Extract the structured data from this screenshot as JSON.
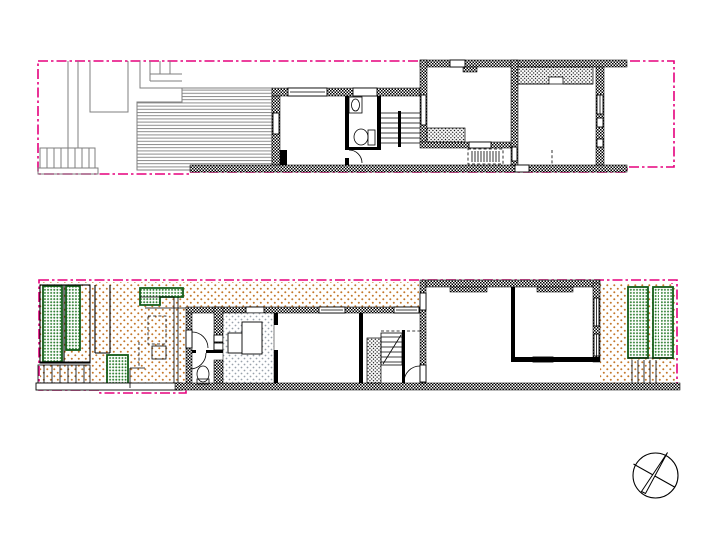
{
  "colors": {
    "boundary-pink": "#e5007d",
    "stipple-orange": "#c4782c",
    "planting-green": "#2b7c2e",
    "green-outline": "#135c18",
    "floor-gray": "#99a2ac",
    "deck-gray": "#8c8c8c",
    "line-gray": "#7f7f7f",
    "ink": "#000000",
    "paper": "#ffffff"
  },
  "symbols": {
    "north_arrow_icon": "north-arrow-compass",
    "boundary_line_style": "pink dash-dot site boundary",
    "wall_fill": "black crosshatch",
    "garden_ground_fill": "orange stipple dots",
    "planting_fill": "green stipple dots with dark green outline",
    "outbuilding_floor_fill": "gray stipple dots",
    "deck_fill": "gray horizontal lines",
    "stair_symbol": "parallel treads",
    "door_symbol": "quarter-circle swing arc"
  }
}
